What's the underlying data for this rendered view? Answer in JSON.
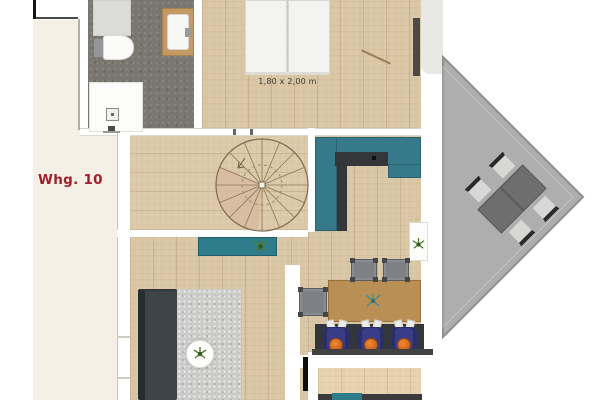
{
  "plan": {
    "unit_label": "Whg. 10",
    "bed_size_label": "1,80 x 2,00 m",
    "colors": {
      "label_red": "#a01f2b",
      "kitchen_teal": "#35798a",
      "wood_floor": "#d9c6a5",
      "dining_table_wood": "#ba8f55",
      "bathroom_tile_gray": "#7a7771",
      "balcony_gray": "#aeaeae",
      "dark_counter": "#35363a",
      "sofa_charcoal": "#3e4549",
      "chair_navy": "#393c86",
      "cushion_orange": "#d2691e",
      "background_cream": "#f4f0e6"
    }
  }
}
